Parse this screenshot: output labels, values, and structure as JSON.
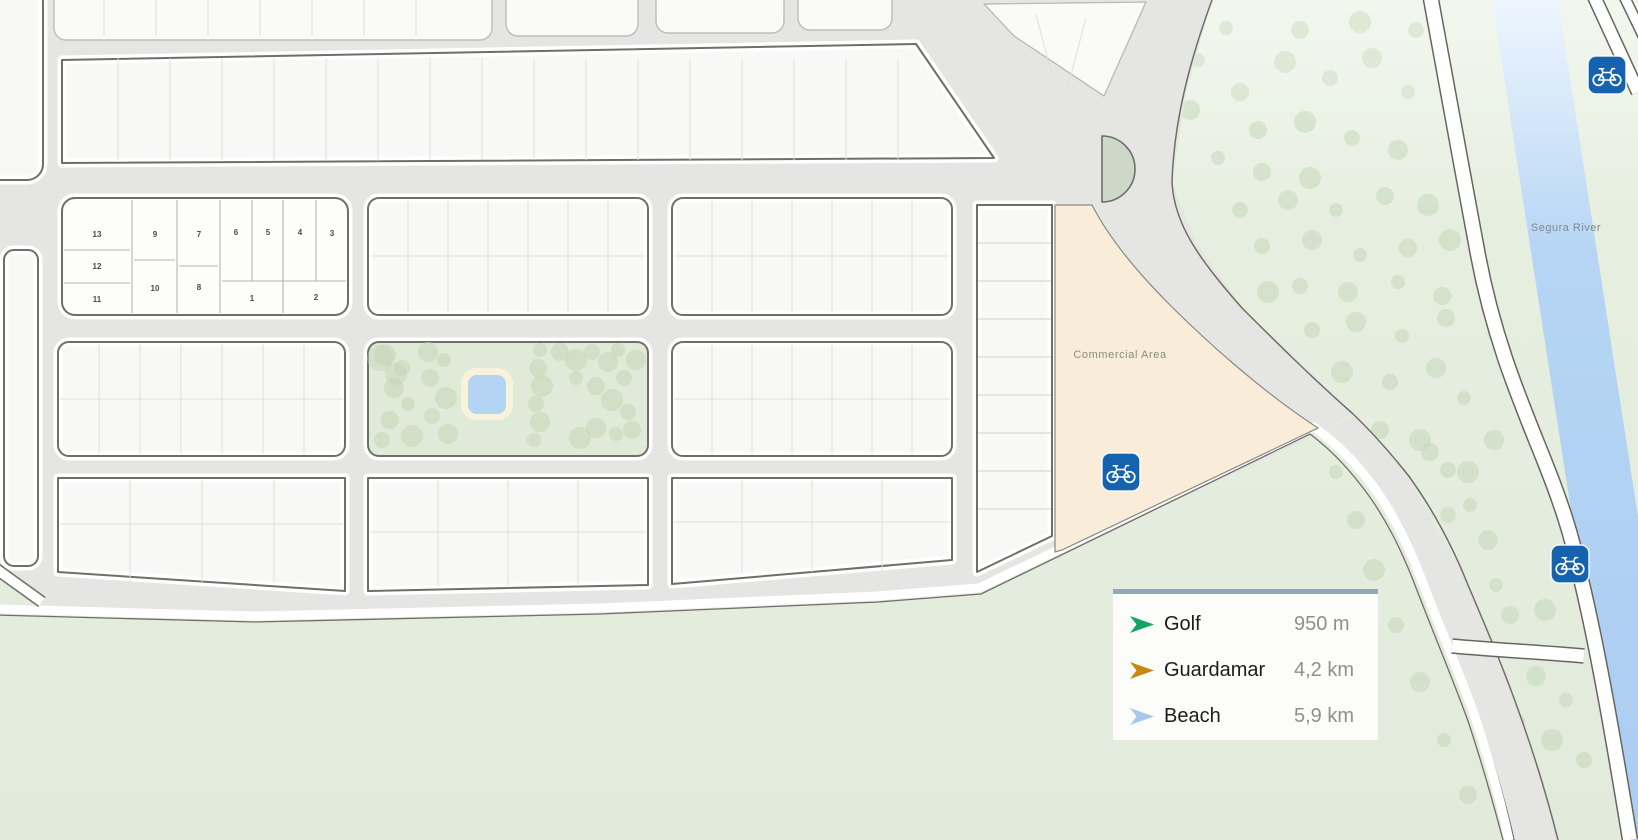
{
  "map": {
    "region_labels": {
      "commercial_area": "Commercial Area",
      "river": "Segura River"
    },
    "plot_numbers": {
      "n1": "1",
      "n2": "2",
      "n3": "3",
      "n4": "4",
      "n5": "5",
      "n6": "6",
      "n7": "7",
      "n8": "8",
      "n9": "9",
      "n10": "10",
      "n11": "11",
      "n12": "12",
      "n13": "13"
    },
    "icons": {
      "bike_sign": "bicycle-icon",
      "legend_arrow": "direction-arrow-icon"
    },
    "colors": {
      "road_gray": "#e5e6e3",
      "block_fill": "#f8f8f6",
      "block_outline": "#6f6f68",
      "green_area": "#e4ecdd",
      "tree": "#c2d5b7",
      "park": "#e0ead8",
      "pool": "#b5d3f2",
      "pool_ring": "#f7f2da",
      "commercial": "#f9ecd8",
      "river": "#abcdf1",
      "bike_sign_blue": "#1563ae",
      "roundabout_island": "#cdd8c8"
    }
  },
  "legend": {
    "accent_border": "#92a8b5",
    "items": [
      {
        "label": "Golf",
        "distance": "950 m",
        "color": "#13a562"
      },
      {
        "label": "Guardamar",
        "distance": "4,2 km",
        "color": "#c8870f"
      },
      {
        "label": "Beach",
        "distance": "5,9 km",
        "color": "#a9c8e9"
      }
    ]
  }
}
